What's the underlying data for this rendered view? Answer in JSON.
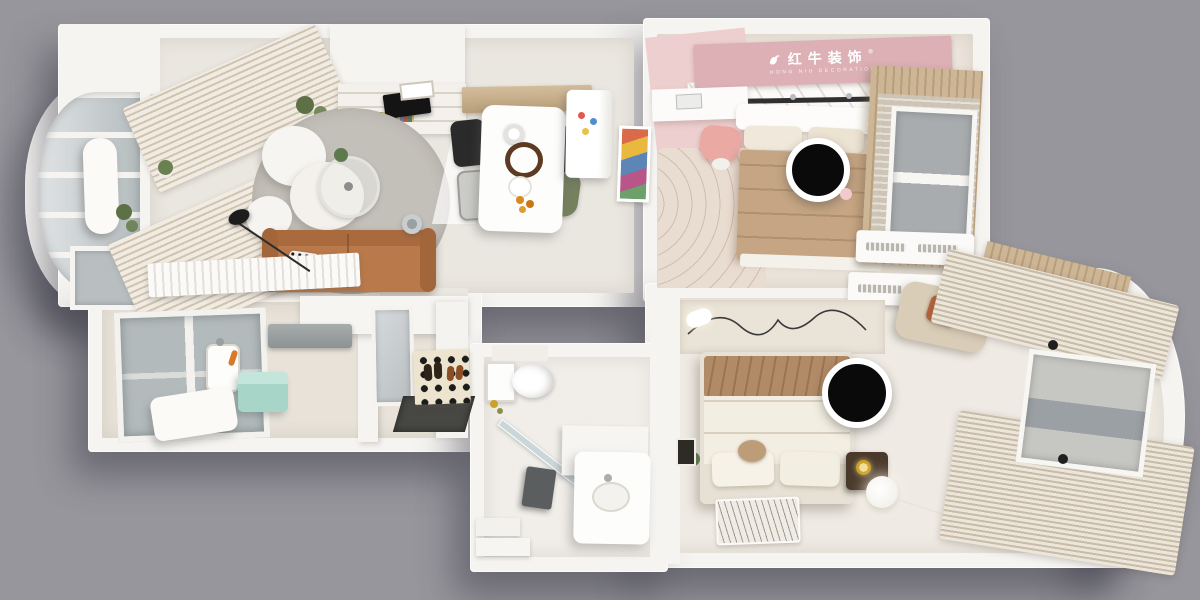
{
  "branding": {
    "logo_cn": "红牛装饰",
    "logo_en": "HONG NIU DECORATION",
    "trademark": "®"
  },
  "colors": {
    "bg": "#97969c",
    "wall": "#f6f4f1",
    "wallShade": "#dedad4",
    "floorLiving": "#eae6e0",
    "floorKitchen": "#e8e2d9",
    "floorBath": "#f1eee9",
    "floorBedroom": "#efebe4",
    "floorPink": "#ece5dc",
    "pinkWall": "#e7c6c6",
    "pinkBanner": "#dcb0b5",
    "pinkRug": "#e9ddd2",
    "wood": "#c9b190",
    "sofa": "#b9794a",
    "sofaDark": "#9d6036",
    "rug": "#bcb8b2",
    "tan": "#c5a583",
    "blanket": "#b18a66",
    "cream": "#f3eee2",
    "green": "#75805f",
    "mint": "#a7d6c8",
    "glass": "#b3babc",
    "dark": "#161616",
    "rust": "#b4633a",
    "gold": "#c9a227"
  },
  "rooms": [
    {
      "id": "balcony",
      "items": [
        "curved-glass-wall",
        "storage-column",
        "plants",
        "low-window"
      ]
    },
    {
      "id": "living-room",
      "items": [
        "striped-curtains",
        "cloud-armchair",
        "round-gray-rug",
        "glass-coffee-table",
        "leather-sofa",
        "polka-pillow",
        "floor-lamp",
        "tv",
        "bookshelf",
        "radiator",
        "pendant-cone-lamp",
        "chrome-fan"
      ]
    },
    {
      "id": "dining-room",
      "items": [
        "wood-sideboard",
        "white-dining-table",
        "pendant-lamp",
        "black-chairs",
        "green-chair",
        "gray-chair",
        "fridge-with-magnets",
        "colorful-artwork",
        "fruit-plate"
      ]
    },
    {
      "id": "kitchen",
      "items": [
        "window",
        "range-hood",
        "upper-cabinets",
        "sink",
        "mint-appliance",
        "white-appliance",
        "food-items"
      ]
    },
    {
      "id": "entry",
      "items": [
        "mirror-cabinet",
        "dark-floor",
        "patterned-shoe-mat",
        "shoes"
      ]
    },
    {
      "id": "pink-bedroom",
      "items": [
        "brand-banner",
        "pink-wall",
        "desk",
        "laptop",
        "pink-chair",
        "wavy-rug",
        "bed-tan-duvet",
        "privacy-circle",
        "wood-wardrobe",
        "sheer-curtain",
        "window",
        "air-conditioner",
        "curtain-rail"
      ]
    },
    {
      "id": "master-bedroom",
      "items": [
        "air-conditioner",
        "beige-armchair",
        "rust-pillow",
        "line-art-wall",
        "bed-cream-duvet",
        "tan-blanket",
        "privacy-circle",
        "nightstand",
        "gold-lamp",
        "sphere-floor-lamp",
        "zebra-rug",
        "long-curtains",
        "bay-window",
        "wood-slats"
      ]
    },
    {
      "id": "bathroom",
      "items": [
        "toilet",
        "glass-partition",
        "half-wall",
        "shower-panel",
        "vanity-sink",
        "steps",
        "gold-fixtures"
      ]
    }
  ]
}
